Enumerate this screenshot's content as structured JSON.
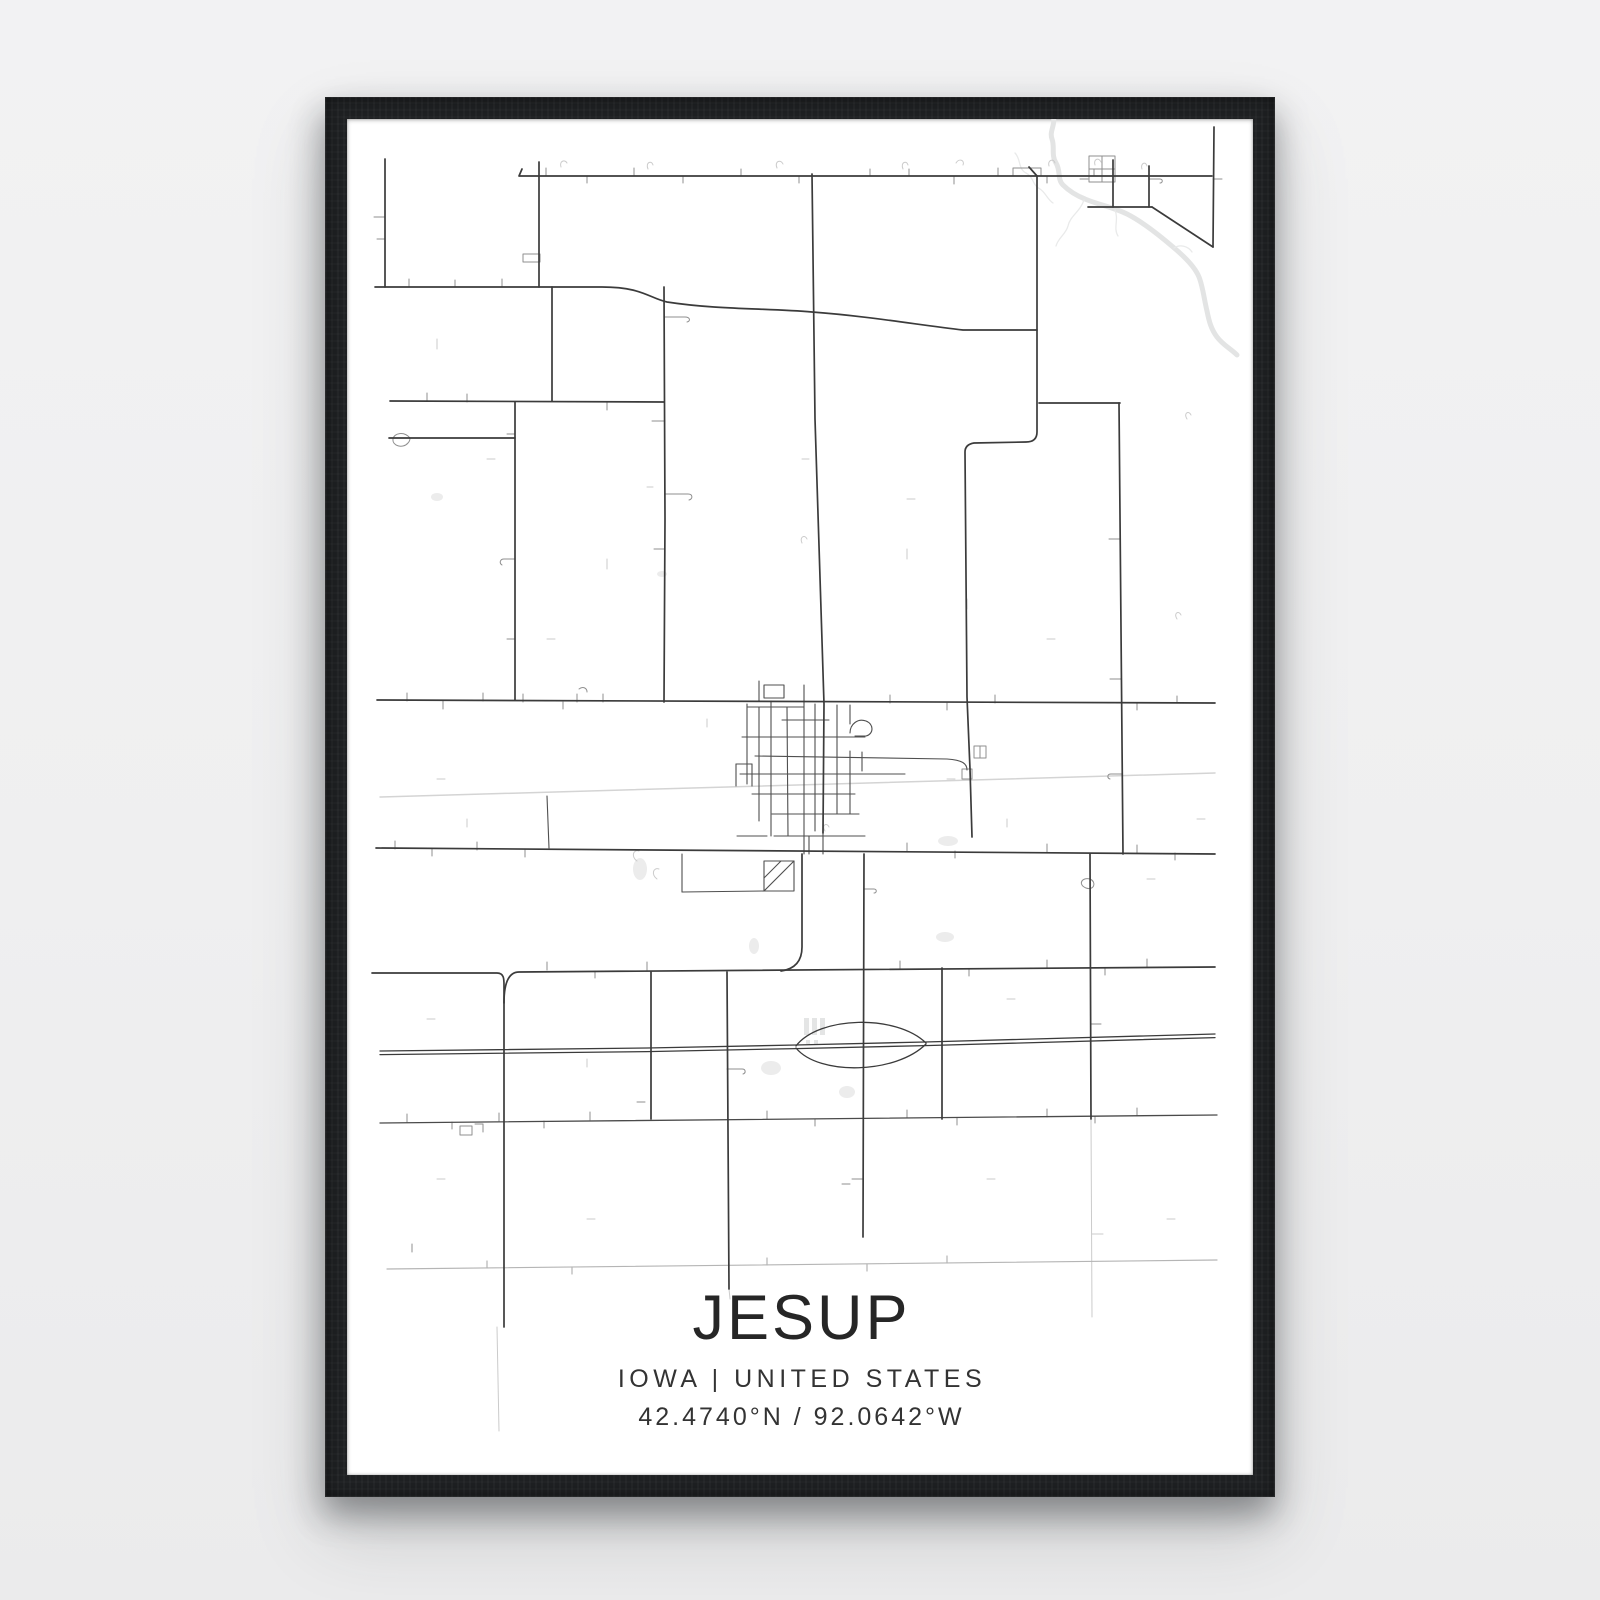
{
  "poster": {
    "city": "JESUP",
    "region_line": "IOWA | UNITED STATES",
    "coordinates_line": "42.4740°N / 92.0642°W",
    "state": "IOWA",
    "country": "UNITED STATES",
    "latitude": "42.4740°N",
    "longitude": "92.0642°W"
  },
  "colors": {
    "background": "#f0f0f1",
    "frame": "#1e2022",
    "paper": "#ffffff",
    "title_text": "#262626",
    "subtitle_text": "#333333",
    "major_road": "#3b3b3b",
    "town_road": "#4f4f4f",
    "minor_road": "#8f8f8f",
    "light_detail": "#cbcbcb",
    "railway": "#d4d4d4",
    "river": "#e3e4e4",
    "water_fill": "#ececec",
    "building_fill": "#e4e5e5"
  },
  "map": {
    "viewbox": "0 0 906 1356",
    "layers": [
      {
        "name": "river",
        "color": "#e3e4e4",
        "width": 5,
        "paths": [
          "M706,-4 C709,6 702,12 705,20 C708,28 704,36 709,44 C714,52 710,60 716,66 C722,72 728,76 738,80 C752,86 766,88 780,95 C796,103 812,116 826,128 C838,138 848,148 852,158 C856,168 857,180 860,192 C862,202 864,210 870,218 C876,226 884,230 890,236"
        ]
      },
      {
        "name": "streams",
        "color": "#e9eaea",
        "width": 1.3,
        "paths": [
          "M668,34 C674,40 671,50 679,54 C687,58 685,66 693,70 C699,74 700,80 706,84",
          "M737,81 C733,93 723,97 721,107 C719,115 711,119 709,127",
          "M768,91 C772,101 766,109 771,117",
          "M827,129 C833,125 841,127 845,133"
        ]
      },
      {
        "name": "ponds",
        "fill": true,
        "color": "#ececec",
        "ellipses": [
          {
            "cx": 293,
            "cy": 750,
            "rx": 7,
            "ry": 11
          },
          {
            "cx": 407,
            "cy": 827,
            "rx": 5,
            "ry": 8
          },
          {
            "cx": 598,
            "cy": 818,
            "rx": 9,
            "ry": 5
          },
          {
            "cx": 424,
            "cy": 949,
            "rx": 10,
            "ry": 7
          },
          {
            "cx": 500,
            "cy": 973,
            "rx": 8,
            "ry": 6
          },
          {
            "cx": 601,
            "cy": 722,
            "rx": 10,
            "ry": 5
          },
          {
            "cx": 90,
            "cy": 378,
            "rx": 6,
            "ry": 4
          },
          {
            "cx": 315,
            "cy": 455,
            "rx": 5,
            "ry": 3
          }
        ]
      },
      {
        "name": "buildings",
        "fill": true,
        "color": "#e4e5e5",
        "rects": [
          {
            "x": 457,
            "y": 899,
            "w": 5,
            "h": 17
          },
          {
            "x": 465,
            "y": 899,
            "w": 5,
            "h": 17
          },
          {
            "x": 473,
            "y": 899,
            "w": 5,
            "h": 17
          },
          {
            "x": 459,
            "y": 921,
            "w": 4,
            "h": 4
          },
          {
            "x": 467,
            "y": 921,
            "w": 4,
            "h": 4
          }
        ]
      },
      {
        "name": "railway",
        "color": "#d4d4d4",
        "width": 1.5,
        "paths": [
          "M33,678 L868,654"
        ]
      },
      {
        "name": "light-details",
        "color": "#cbcbcb",
        "width": 1,
        "paths": [
          "M214,48 C212,42 218,40 220,44",
          "M301,50 C298,43 305,41 306,46",
          "M430,49 C427,42 434,40 436,45",
          "M556,50 C553,43 560,41 561,46",
          "M609,44 C612,39 618,41 616,46",
          "M702,47 C700,41 707,39 708,44",
          "M748,46 C746,40 752,38 754,43",
          "M795,50 C793,44 799,42 800,47",
          "M90,220 L90,230",
          "M140,340 L148,340",
          "M260,440 L260,450",
          "M200,520 L208,520",
          "M90,660 L98,660",
          "M120,700 L120,708",
          "M560,380 L568,380",
          "M620,480 L620,490",
          "M700,520 L708,520",
          "M360,600 L360,608",
          "M600,660 L608,660",
          "M660,700 L660,708",
          "M80,900 L88,900",
          "M240,940 L240,948",
          "M660,880 L668,880",
          "M800,760 L808,760",
          "M850,700 L858,700",
          "M90,1060 L98,1060",
          "M240,1100 L248,1100",
          "M640,1060 L648,1060",
          "M820,1100 L828,1100",
          "M290,742 C284,738 286,730 292,732",
          "M310,760 C304,756 306,748 312,750",
          "M478,712 C474,706 480,703 482,708",
          "M150,1208 L152,1312",
          "M744,1000 L745,1198",
          "M745,1115 L756,1115",
          "M382,1170 L383,1180",
          "M455,424 C452,418 458,415 460,420",
          "M560,430 L560,440",
          "M840,300 C836,294 842,291 844,296",
          "M830,500 C826,494 832,491 834,496",
          "M455,340 L462,340",
          "M300,368 L306,368"
        ]
      },
      {
        "name": "rural-road",
        "color": "#b5b5b5",
        "width": 1.2,
        "paths": [
          "M40,1150 L870,1141",
          "M140,1149 L140,1142",
          "M225,1148 L225,1155",
          "M420,1146 L420,1139",
          "M520,1145 L520,1152",
          "M600,1144 L600,1137"
        ]
      },
      {
        "name": "minor-roads",
        "color": "#8f8f8f",
        "width": 1,
        "paths": [
          "M27,98 L38,98",
          "M38,120 L30,120",
          "M199,57 L199,49",
          "M240,57 L240,64",
          "M287,57 L287,49",
          "M336,57 L336,64",
          "M394,57 L394,50",
          "M452,57 L452,64",
          "M523,57 L523,50",
          "M562,57 L562,50",
          "M607,57 L607,65",
          "M651,57 L651,49",
          "M700,57 L700,64",
          "M747,57 L747,50",
          "M666,57 L666,49 L694,49 L694,57",
          "M176,135 L193,135 L193,143 L176,143 Z",
          "M62,168 L62,160",
          "M108,168 L108,161",
          "M155,160 L155,168",
          "M317,198 L338,198 C343,198 344,202 340,203",
          "M318,302 L305,302",
          "M318,375 L341,375 C346,375 346,380 342,381",
          "M317,430 L307,430",
          "M168,315 L160,315",
          "M168,440 L157,440 C153,440 152,444 155,446",
          "M168,520 L160,520",
          "M80,282 L80,274",
          "M120,283 L120,275",
          "M260,283 L260,291",
          "M63,319 C57,312 47,314 46,320 C45,327 56,330 61,324 C63,322 63,320 63,319",
          "M60,582 L60,574",
          "M96,582 L96,590",
          "M136,582 L136,574",
          "M176,583 L176,575",
          "M216,583 L216,590",
          "M256,583 L256,575",
          "M543,584 L543,576",
          "M600,584 L600,591",
          "M648,584 L648,576",
          "M790,584 L790,591",
          "M830,584 L830,577",
          "M230,575 L230,583",
          "M232,570 C236,567 240,569 240,573",
          "M48,730 L48,722",
          "M85,730 L85,737",
          "M130,731 L130,723",
          "M178,731 L178,738",
          "M560,732 L560,724",
          "M608,732 L608,739",
          "M700,733 L700,725",
          "M790,734 L790,726",
          "M828,734 L828,741",
          "M200,851 L200,843",
          "M248,852 L248,859",
          "M300,851 L300,843",
          "M553,850 L553,842",
          "M622,850 L622,857",
          "M700,849 L700,841",
          "M758,849 L758,856",
          "M800,848 L800,840",
          "M298,983 L290,983",
          "M503,1065 L495,1065",
          "M60,1003 L60,995",
          "M105,1003 L105,1010",
          "M152,1002 L152,994",
          "M197,1002 L197,1009",
          "M243,1001 L243,993",
          "M420,1000 L420,992",
          "M468,1000 L468,1007",
          "M560,999 L560,991",
          "M610,999 L610,1006",
          "M700,998 L700,990",
          "M748,997 L748,1004",
          "M790,997 L790,989",
          "M113,1007 L125,1007 L125,1016 L113,1016 Z",
          "M128,1005 L136,1005 L136,1013",
          "M65,1125 L65,1133",
          "M516,1060 L505,1060",
          "M517,770 L527,770 C530,770 530,774 527,774",
          "M743,760 C734,758 731,766 739,769 C747,772 750,763 743,760",
          "M744,905 L754,905",
          "M773,420 L762,420",
          "M774,560 L763,560",
          "M775,655 L764,655 C760,655 760,659 763,660",
          "M866,60 L875,60",
          "M742,37 L768,37 L768,63 L742,63 Z",
          "M755,37 L755,63",
          "M742,50 L768,50",
          "M741,60 L733,60",
          "M802,60 L813,60 C816,60 816,64 813,64",
          "M615,650 L625,650 L625,660 L615,660 Z",
          "M627,627 L639,627 L639,639 L627,639 Z",
          "M633,627 L633,639",
          "M380,950 L395,950 C399,950 399,954 396,955"
        ]
      },
      {
        "name": "town-roads",
        "color": "#4f4f4f",
        "width": 1.1,
        "paths": [
          "M400,585 L400,665",
          "M412,588 L412,702",
          "M424,582 L424,717",
          "M440,588 L441,717",
          "M457,581 L457,735",
          "M468,585 L468,712",
          "M490,586 L490,695",
          "M503,586 L503,605",
          "M503,632 L503,695",
          "M515,633 L515,652",
          "M400,588 L457,588",
          "M435,601 L482,601",
          "M395,618 L518,618",
          "M408,637 L600,640 C616,641 620,645 620,651",
          "M393,655 L558,655",
          "M405,675 L508,675",
          "M425,695 L512,695",
          "M390,717 L420,717",
          "M427,717 L518,717",
          "M503,614 C503,605 511,599 519,602 C527,605 527,615 519,617 L508,617",
          "M462,717 L462,735",
          "M476,695 L476,735",
          "M412,562 L412,582",
          "M457,566 L457,581",
          "M417,566 L437,566 L437,579 L417,579 Z",
          "M389,645 L405,645",
          "M389,645 L389,667",
          "M405,645 L405,667",
          "M417,742 L447,742 L447,772 L417,772 Z",
          "M447,742 L417,772",
          "M434,742 L417,759",
          "M335,735 L335,773",
          "M335,773 L417,772",
          "M200,677 L202,729"
        ]
      },
      {
        "name": "highway",
        "color": "#3b3b3b",
        "width": 1.3,
        "paths": [
          "M33,932 L300,929 L449,926 L578,923 L868,915",
          "M33,935.6 L300,932.6 L449,929.6 L578,926.6 L868,918.6",
          "M449,927 C472,897 549,895 579,924",
          "M449,929 C472,957 549,955 579,925"
        ]
      },
      {
        "name": "secondary-roads",
        "color": "#4a4a4a",
        "width": 1.3,
        "paths": [
          "M33,1004 L870,996"
        ]
      },
      {
        "name": "major-roads",
        "color": "#3b3b3b",
        "width": 1.7,
        "paths": [
          "M38,40 L38,168",
          "M192,43 L192,168",
          "M175,50 L172,57 L865,57",
          "M465,55 L468,300 L477,585 L476,714",
          "M28,168 L255,168 C295,168 302,179 320,183 C372,191 420,189 465,193 C520,197 572,206 616,211 L690,211",
          "M682,48 L690,57 L690,313 C690,321 685,323 679,323 L627,324 C621,325 618,328 618,333 L620,578 L623,650 L625,718",
          "M205,168 L205,282",
          "M317,168 L318,400 L317,583",
          "M43,282 L317,283",
          "M42,319 L168,319",
          "M692,284 L773,284",
          "M772,284 L776,735",
          "M168,283 L168,581",
          "M30,581 L868,584",
          "M29,729 L868,735",
          "M25,854 L150,854 C157,854 157,860 157,866 L157,1208",
          "M157,884 C157,868 160,853 172,853 L868,848",
          "M455,735 L455,828 C455,842 448,850 434,852",
          "M517,735 L516,1118",
          "M380,853 L382,1170",
          "M304,853 L304,1000",
          "M595,849 L595,1000",
          "M743,735 L744,1000",
          "M867,8 L866,128",
          "M805,88 L866,128",
          "M766,41 L766,88",
          "M802,47 L802,88",
          "M741,88 L805,88"
        ]
      }
    ]
  }
}
